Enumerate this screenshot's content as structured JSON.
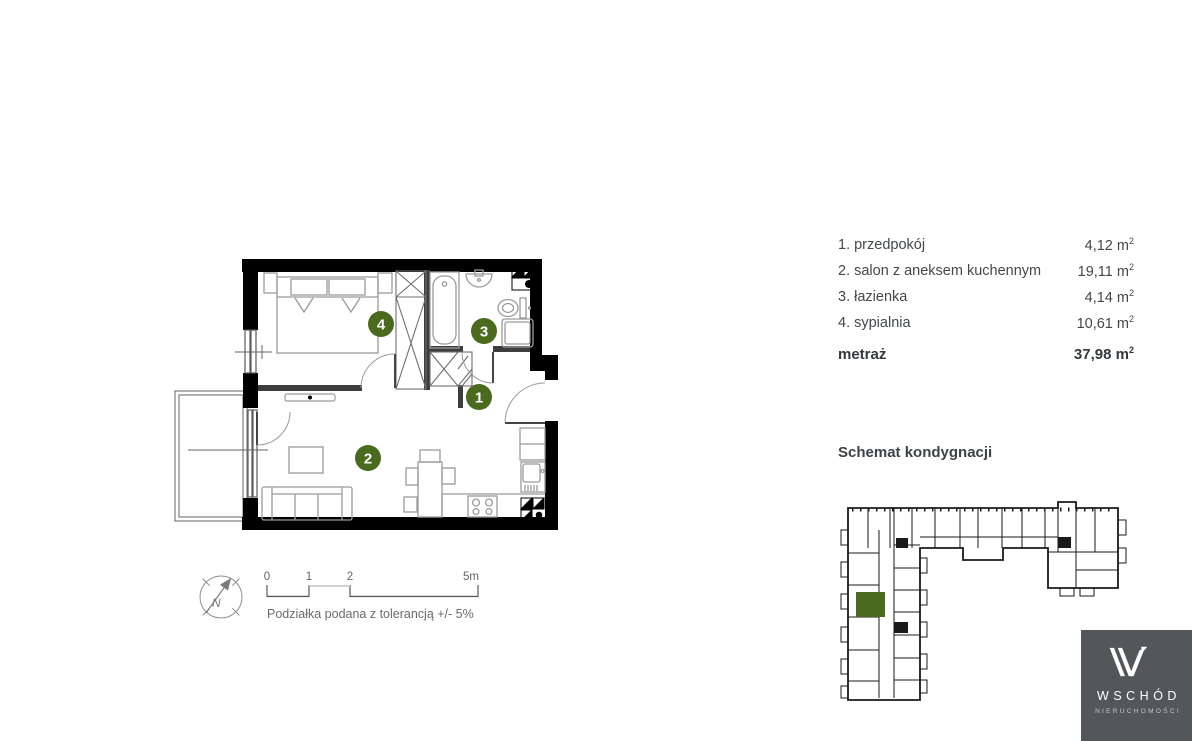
{
  "legend": {
    "rows": [
      {
        "label": "1. przedpokój",
        "area": "4,12"
      },
      {
        "label": "2. salon z aneksem kuchennym",
        "area": "19,11"
      },
      {
        "label": "3. łazienka",
        "area": "4,14"
      },
      {
        "label": "4. sypialnia",
        "area": "10,61"
      }
    ],
    "total_label": "metraż",
    "total_area": "37,98",
    "unit": "m",
    "unit_exp": "2"
  },
  "plan": {
    "room_labels": [
      {
        "number": "1"
      },
      {
        "number": "2"
      },
      {
        "number": "3"
      },
      {
        "number": "4"
      }
    ],
    "compass_label": "N",
    "scale": {
      "ticks": [
        "0",
        "1",
        "2",
        "5m"
      ],
      "caption": "Podziałka podana z tolerancją +/- 5%"
    }
  },
  "schematic": {
    "title": "Schemat kondygnacji"
  },
  "logo": {
    "name": "WSCHÓD",
    "subtitle": "NIERUCHOMOŚCI"
  },
  "colors": {
    "accent_green": "#4a6b1e",
    "logo_background": "#54575a",
    "walls": "#000000"
  }
}
